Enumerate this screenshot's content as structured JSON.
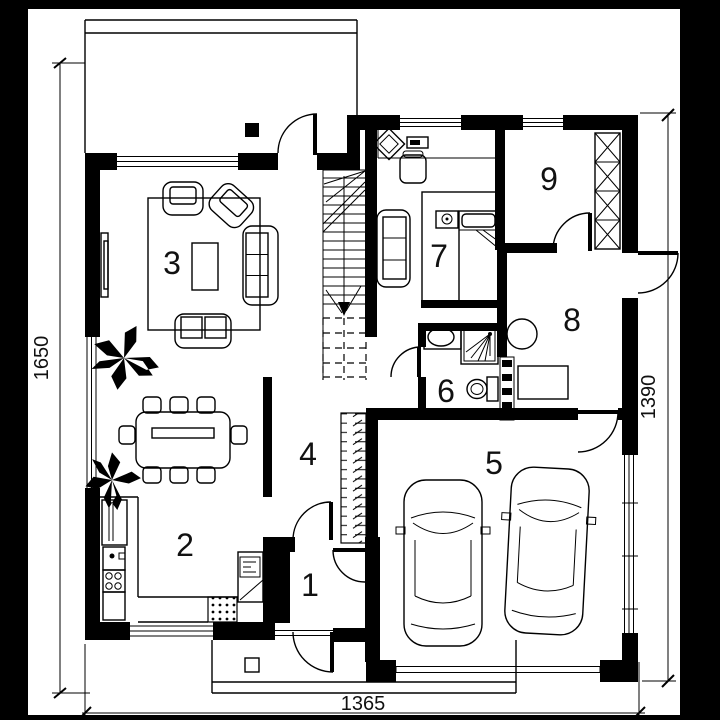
{
  "colors": {
    "ink": "#000000",
    "paper": "#ffffff"
  },
  "room_numbers": [
    "1",
    "2",
    "3",
    "4",
    "5",
    "6",
    "7",
    "8",
    "9"
  ],
  "dimensions": {
    "left_height": "1650",
    "bottom_width": "1365",
    "right_height": "1390"
  }
}
